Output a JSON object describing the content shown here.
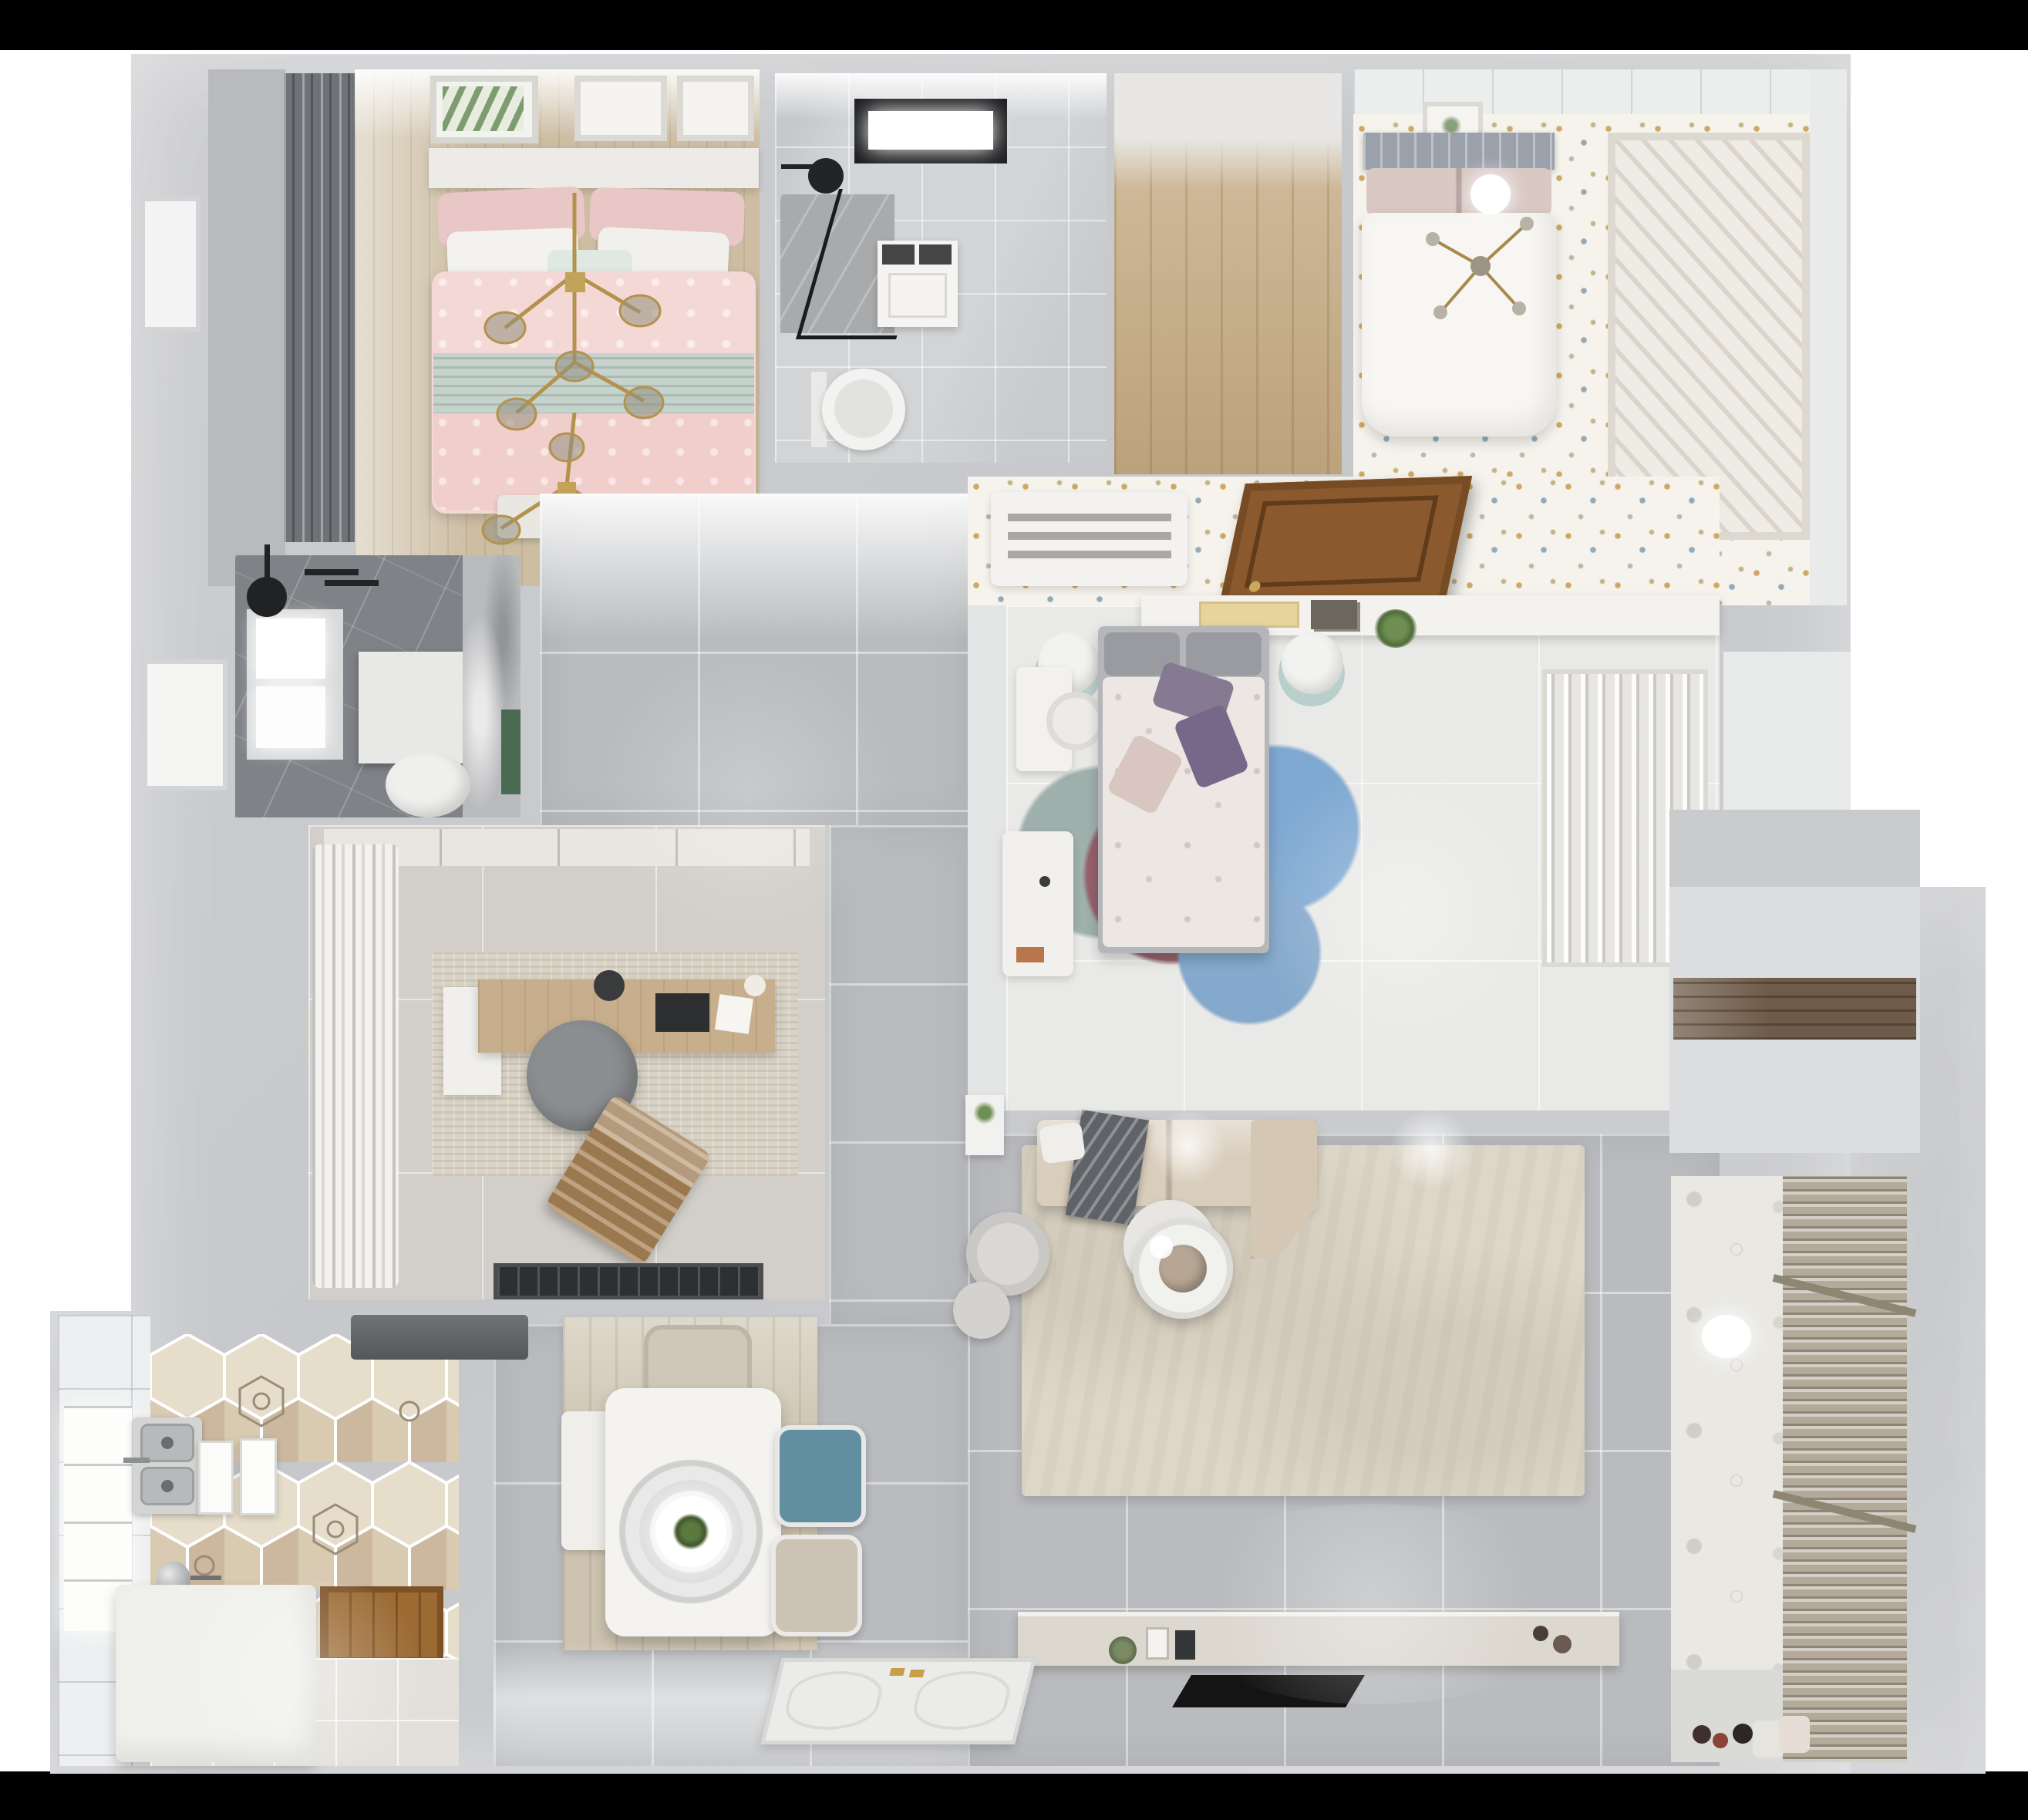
{
  "scene": {
    "kind": "photoreal 3D floor-plan render, top-down view, no visible text",
    "background": "#000000",
    "apartment": {
      "rooms": [
        {
          "name": "bedroom-pink",
          "position": "top-left",
          "furniture": [
            "pink-double-bed",
            "mint-throw",
            "dark-curtains",
            "three-wall-frames",
            "gold-branch-chandelier",
            "foot-bench"
          ]
        },
        {
          "name": "bathroom-main",
          "position": "top-center",
          "furniture": [
            "black-frame-window",
            "walk-in-shower",
            "glass-screen",
            "vanity-sink",
            "toilet"
          ]
        },
        {
          "name": "walk-in-closet-empty",
          "position": "top-center-right",
          "furniture": [
            "wood-plank-floor"
          ]
        },
        {
          "name": "bedroom-white",
          "position": "top-right",
          "furniture": [
            "white-double-bed",
            "gray-slat-headboard",
            "slatted-wardrobe",
            "cross-chandelier",
            "wall-frame",
            "confetti-dot-floor"
          ]
        },
        {
          "name": "hallway",
          "position": "center",
          "furniture": [
            "ac-vent-grille",
            "open-wood-door",
            "long-shelf-with-plant",
            "confetti-dot-floor"
          ]
        },
        {
          "name": "bathroom-dark",
          "position": "middle-left",
          "furniture": [
            "window",
            "black-shower-head",
            "shower-tray",
            "toilet",
            "marble-wall",
            "green-accent"
          ]
        },
        {
          "name": "study",
          "position": "middle-left-lower",
          "furniture": [
            "white-curtains",
            "wood-desk",
            "gray-round-chair",
            "brown-lounge-chair",
            "distressed-rug",
            "black-doormat"
          ]
        },
        {
          "name": "bedroom-center",
          "position": "center-right",
          "furniture": [
            "floral-duvet-bed",
            "purple-pillows",
            "circle-rug-blue-maroon",
            "headboard-shelf-books",
            "bedside-stools",
            "desk",
            "dresser",
            "open-wardrobe-clothes"
          ]
        },
        {
          "name": "kitchen",
          "position": "bottom-left",
          "furniture": [
            "hexagon-tile-floor",
            "double-basin-sink",
            "range-hood",
            "white-counter-island",
            "window",
            "wood-threshold",
            "standing-panels"
          ]
        },
        {
          "name": "dining",
          "position": "bottom-center-left",
          "furniture": [
            "white-table",
            "ring-pendant-lamp",
            "plant-centerpiece",
            "teal-chair",
            "two-beige-chairs",
            "white-bench",
            "wood-rug"
          ]
        },
        {
          "name": "living",
          "position": "bottom-center-right",
          "furniture": [
            "beige-sectional-sofa",
            "gray-throw",
            "cream-rug",
            "round-coffee-table",
            "round-armchair",
            "ottoman",
            "tv-console-with-decor",
            "flat-tv-panel",
            "side-table-plant"
          ]
        },
        {
          "name": "balcony-laundry",
          "position": "bottom-right",
          "furniture": [
            "venetian-blinds",
            "patterned-tile-wall",
            "ceiling-light",
            "floor-toys",
            "towels"
          ]
        },
        {
          "name": "storage",
          "position": "right-middle",
          "furniture": [
            "dark-wood-shelf-band"
          ]
        }
      ],
      "entry": {
        "name": "entrance-door",
        "position": "bottom-center",
        "details": [
          "white-panel-door",
          "gold-handles"
        ]
      }
    }
  },
  "palette": {
    "background": "#000000",
    "matte": "#ffffff",
    "wall": "#c9cacd",
    "wall_light": "#dfe0e2",
    "tile_gray": "#b9bbbe",
    "tile_light": "#e9e9e7",
    "wood": "#c6ab82",
    "wood_dark": "#8a5a2e",
    "pink_bed": "#f4d8d5",
    "mint": "#c6d3cc",
    "dot_floor": "#f5f3ec",
    "dark_bath": "#7f8286",
    "sofa_beige": "#d9cdbb",
    "rug_cream": "#ded7c8",
    "teal_chair": "#628fa0",
    "rug_blue": "#7fa9d2",
    "rug_maroon": "#95616c",
    "purple_pillow": "#867a92",
    "gold": "#b3924d",
    "tv_black": "#141414",
    "green_plant": "#5c7a3f",
    "hex_tile": "#dbcdb4",
    "blinds": "#b3aa99"
  }
}
